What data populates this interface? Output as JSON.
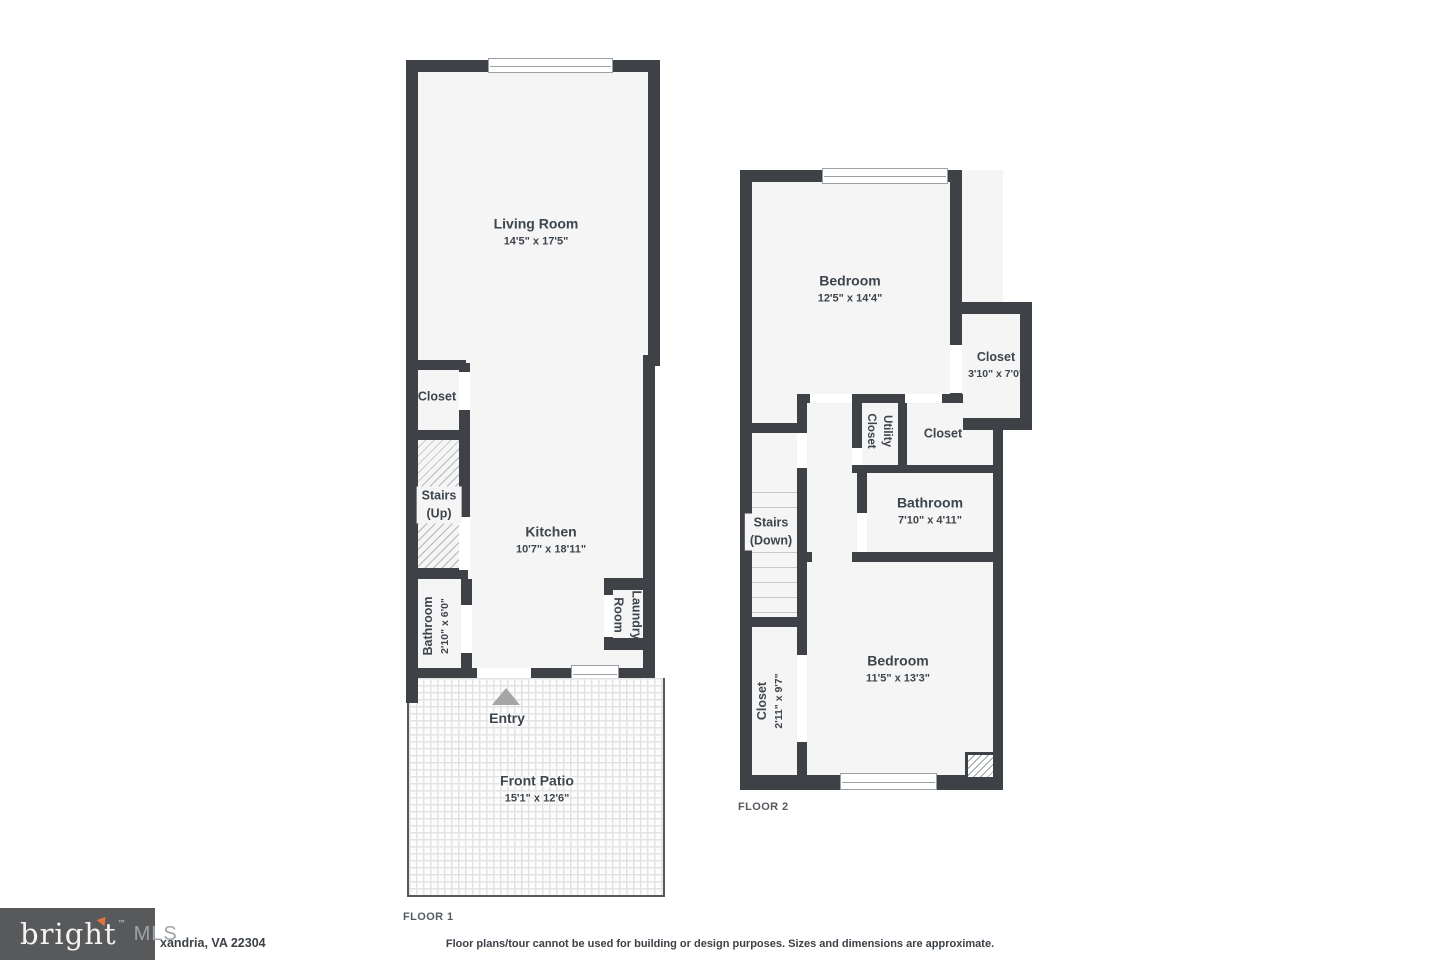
{
  "floor1": {
    "label": "FLOOR 1",
    "living_room": {
      "name": "Living Room",
      "dims": "14'5\" x 17'5\""
    },
    "closet": {
      "name": "Closet"
    },
    "stairs": {
      "name": "Stairs",
      "direction": "(Up)"
    },
    "kitchen": {
      "name": "Kitchen",
      "dims": "10'7\" x 18'11\""
    },
    "bathroom": {
      "name": "Bathroom",
      "dims": "2'10\" x 6'0\""
    },
    "laundry": {
      "line1": "Laundry",
      "line2": "Room"
    },
    "entry": {
      "label": "Entry"
    },
    "patio": {
      "name": "Front Patio",
      "dims": "15'1\" x 12'6\""
    }
  },
  "floor2": {
    "label": "FLOOR 2",
    "bedroom_top": {
      "name": "Bedroom",
      "dims": "12'5\" x 14'4\""
    },
    "closet_right": {
      "name": "Closet",
      "dims": "3'10\" x 7'0\""
    },
    "utility_closet": {
      "line1": "Utility",
      "line2": "Closet"
    },
    "closet_mid": {
      "name": "Closet"
    },
    "bathroom": {
      "name": "Bathroom",
      "dims": "7'10\" x 4'11\""
    },
    "stairs": {
      "name": "Stairs",
      "direction": "(Down)"
    },
    "closet_bottom": {
      "name": "Closet",
      "dims": "2'11\" x 9'7\""
    },
    "bedroom_bottom": {
      "name": "Bedroom",
      "dims": "11'5\" x 13'3\""
    }
  },
  "footer": {
    "logo": {
      "brand": "bright",
      "tm": "™",
      "suffix": "MLS"
    },
    "address": "xandria, VA 22304",
    "disclaimer": "Floor plans/tour cannot be used for building or design purposes. Sizes and dimensions are approximate."
  },
  "colors": {
    "wall": "#3e4246",
    "room_fill": "#f5f5f5",
    "logo_background": "#58595b",
    "logo_arrow": "#e8713c",
    "label_text": "#3d454d"
  }
}
